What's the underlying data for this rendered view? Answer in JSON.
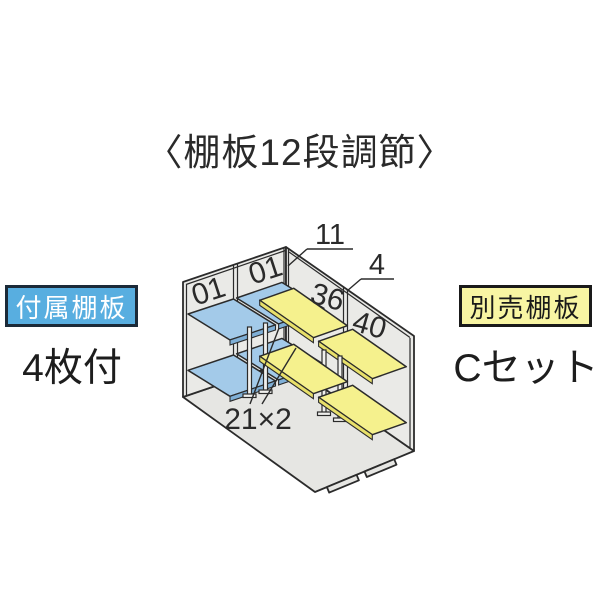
{
  "title": "〈棚板12段調節〉",
  "attached_label": {
    "badge": "付属棚板",
    "caption": "4枚付"
  },
  "optional_label": {
    "badge": "別売棚板",
    "caption": "Cセット"
  },
  "diagram": {
    "dim_top": "11",
    "dim_side": "4",
    "left_wall_numbers": [
      "01",
      "01"
    ],
    "right_wall_numbers": [
      "36",
      "40"
    ],
    "floor_note": "21×2"
  },
  "colors": {
    "text": "#2a2a2a",
    "outline": "#2b2b2b",
    "wall": "#eaeae7",
    "floor": "#e6e6e3",
    "attached-shelf": "#a3cae9",
    "attached-shelf-edge": "#7fafd6",
    "optional-shelf": "#f5f18d",
    "optional-shelf-edge": "#e8e06a",
    "attached-badge-bg": "#58aee0",
    "attached-badge-border": "#1b2a38",
    "attached-badge-text": "#ffffff",
    "optional-badge-bg": "#f8f5a3",
    "optional-badge-border": "#1a1a1a",
    "optional-badge-text": "#1a1a1a"
  }
}
